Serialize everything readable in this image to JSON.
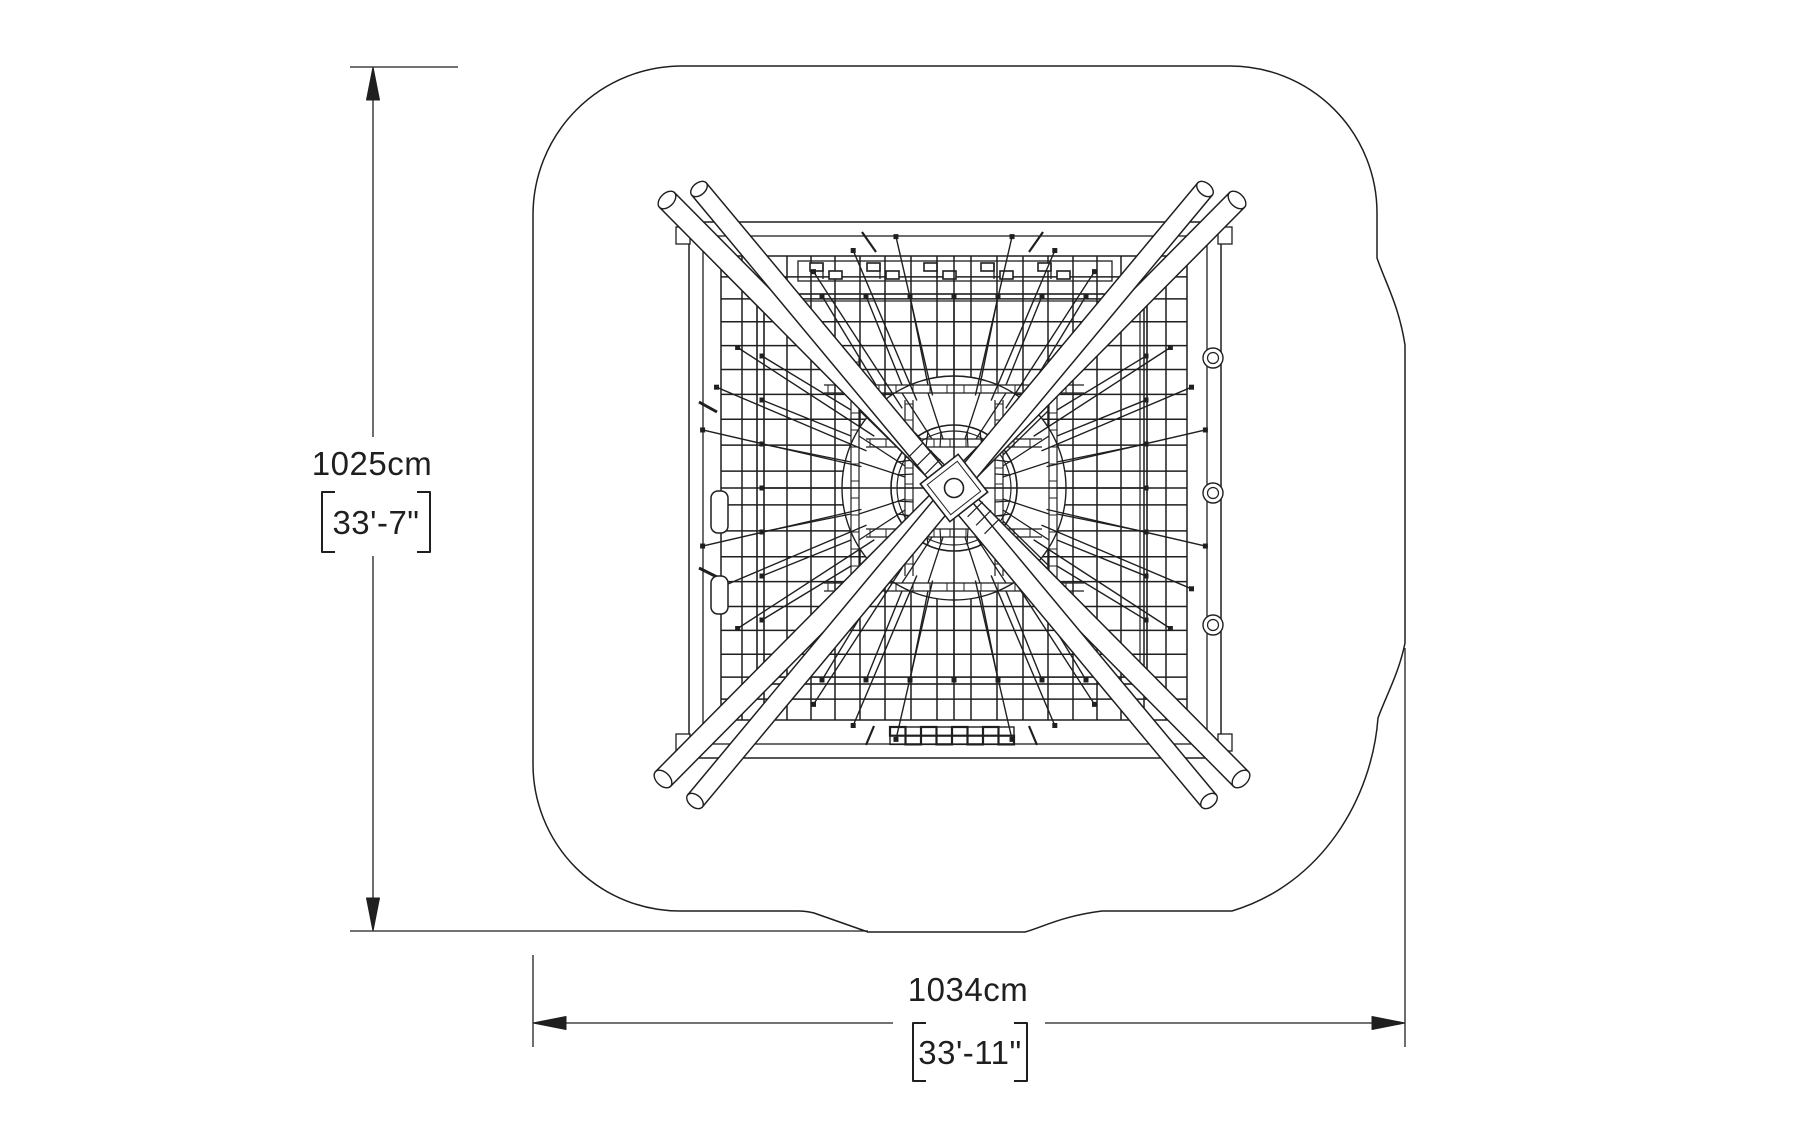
{
  "dimensions": {
    "height": {
      "metric": "1025cm",
      "imperial": "33'-7\""
    },
    "width": {
      "metric": "1034cm",
      "imperial": "33'-11\""
    }
  },
  "colors": {
    "line": "#1f1f1f",
    "background": "#ffffff"
  }
}
